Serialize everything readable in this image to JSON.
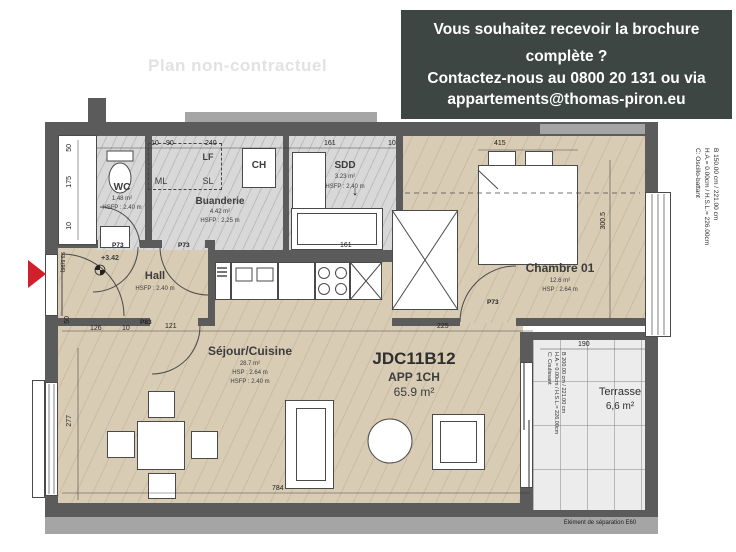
{
  "watermark": "Plan non-contractuel",
  "banner": {
    "line1": "Vous souhaitez recevoir la brochure complète ?",
    "line2": "Contactez-nous au 0800 20 131 ou via",
    "line3": "appartements@thomas-piron.eu",
    "bg_color": "#3d4642",
    "text_color": "#ffffff"
  },
  "unit": {
    "code": "JDC11B12",
    "type": "APP 1CH",
    "area": "65.9 m²"
  },
  "rooms": {
    "wc": {
      "name": "WC",
      "area": "1.48 m²",
      "ceiling": "HSFP : 2.40 m"
    },
    "buanderie": {
      "name": "Buanderie",
      "area": "4.42 m²",
      "ceiling": "HSFP : 2.25 m"
    },
    "sdd": {
      "name": "SDD",
      "area": "3.23 m²",
      "ceiling": "HSFP : 2.40 m"
    },
    "hall": {
      "name": "Hall",
      "ceiling": "HSFP : 2.40 m",
      "level": "+3.42"
    },
    "chambre": {
      "name": "Chambre 01",
      "area": "12.6 m²",
      "ceiling": "HSP : 2.64 m"
    },
    "sejour": {
      "name": "Séjour/Cuisine",
      "area": "28.7 m²",
      "ceiling1": "HSP : 2.64 m",
      "ceiling2": "HSFP : 2.40 m"
    },
    "terrasse": {
      "name": "Terrasse",
      "area": "6,6 m²"
    }
  },
  "appliances": {
    "lf": "LF",
    "ml": "ML",
    "sl": "SL",
    "ch": "CH"
  },
  "doors": {
    "p73": "P73",
    "p83": "P83",
    "entrance_dim": "93.5(96)"
  },
  "windows": {
    "bedroom": {
      "l1": "B 150.00 cm / 221.00 cm",
      "l2": "H.A.= 0.00cm / H.S.L.= 226.00cm",
      "l3": "C: Oscillo-battant"
    },
    "terrace": {
      "l1": "B 200.00 cm / 221.00 cm",
      "l2": "H.A.= 0.00cm / H.S.L.= 226.00cm",
      "l3": "C: Coulissant"
    }
  },
  "notes": {
    "separation": "Elément de séparation E60"
  },
  "dimensions": {
    "a50": "50",
    "a175": "175",
    "a10": "10",
    "b10": "10",
    "b90": "90",
    "b240": "240",
    "b161": "161",
    "c10": "10",
    "d415": "415",
    "d300": "300.5",
    "e161": "161",
    "f50": "50",
    "f126": "126",
    "f10": "10",
    "f121": "121",
    "g225": "225",
    "g277": "277",
    "g784": "784",
    "h190": "190"
  },
  "colors": {
    "wall": "#5b5b5b",
    "floor_beige": "#d9ccb4",
    "floor_gray": "#d8d8d8",
    "terrace": "#ececec",
    "accent_red": "#d21f2c"
  }
}
